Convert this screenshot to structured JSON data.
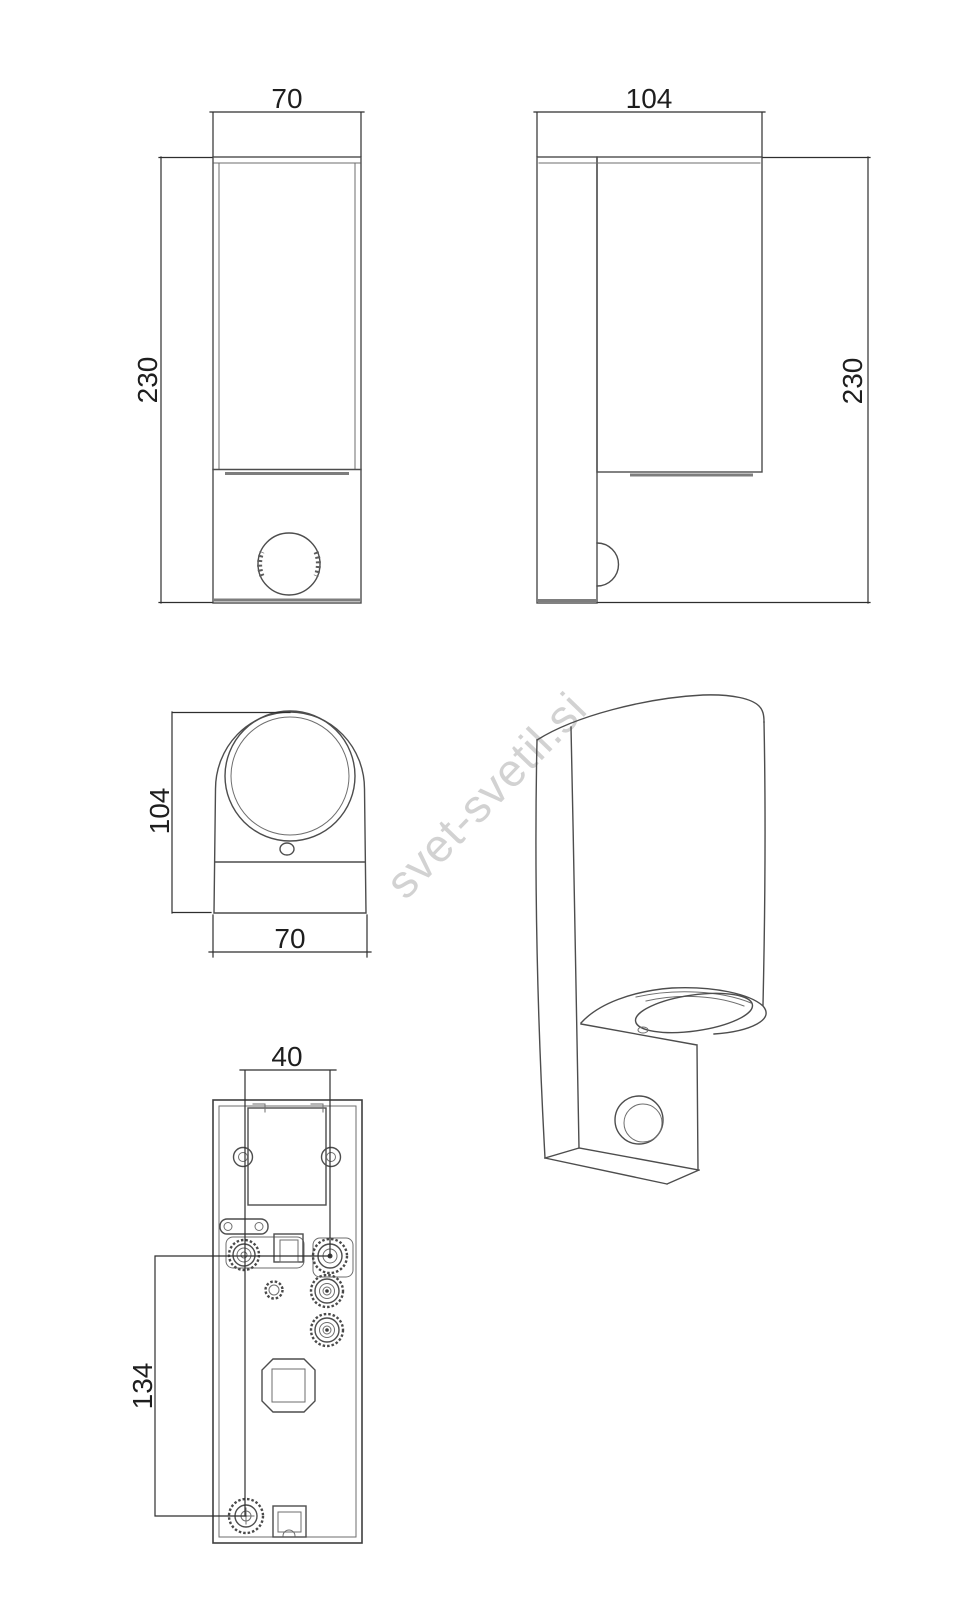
{
  "watermark": {
    "text": "svet-svetil.si",
    "color": "#d2d2d2",
    "rotation_deg": -46
  },
  "views": {
    "front": {
      "label_width": "70",
      "label_height": "230"
    },
    "side": {
      "label_depth": "104",
      "label_height": "230"
    },
    "top": {
      "label_depth": "104",
      "label_width": "70"
    },
    "back": {
      "label_hole_spacing": "40",
      "label_hole_offset": "134"
    }
  },
  "colors": {
    "background": "#ffffff",
    "line": "#4d4d4d",
    "dimension_line": "#2e2e2e",
    "label_text": "#1e1e1e",
    "watermark": "#d2d2d2"
  }
}
